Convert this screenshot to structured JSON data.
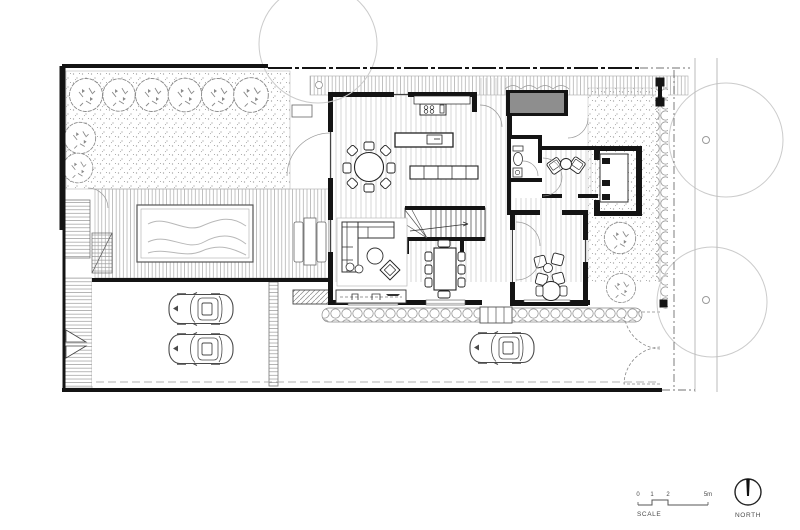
{
  "drawing": {
    "type": "residential-ground-floor-site-plan",
    "annotations": {
      "scale": {
        "label": "SCALE",
        "ticks": [
          "0",
          "1",
          "2",
          "5m"
        ]
      },
      "north": {
        "label": "NORTH"
      }
    },
    "colors": {
      "wall": "#141414",
      "gray_fill": "#8e8e8e",
      "hatch_line": "#9a9a9a",
      "floor_line": "#c6c6c6",
      "canopy": "#cbcbcb",
      "water_line": "#b8b8b8",
      "text": "#4a4a4a",
      "paper": "#ffffff"
    },
    "icons": [
      "tree-icon",
      "street-tree-icon",
      "car-icon",
      "pool-icon",
      "stairs-icon",
      "door-swing-icon",
      "sofa-icon",
      "dining-table-icon",
      "wc-icon",
      "sink-icon",
      "cooktop-icon",
      "window-seat-icon",
      "north-arrow-icon",
      "scale-bar-icon"
    ]
  }
}
